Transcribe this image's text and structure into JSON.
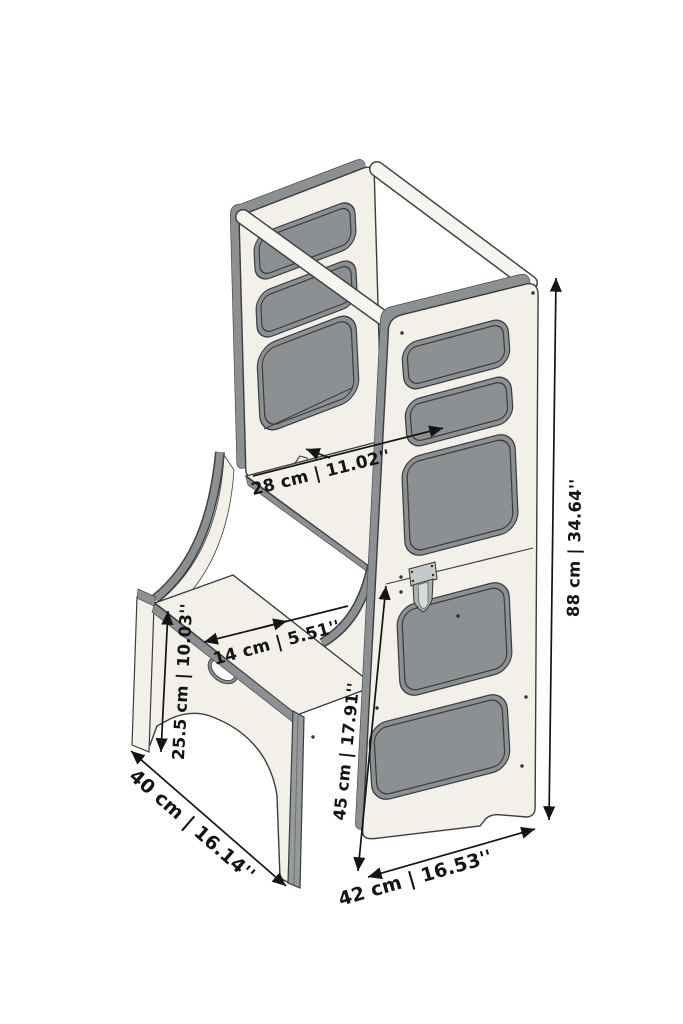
{
  "drawing": {
    "subject": "learning tower with step stool",
    "dimensions": {
      "platform_depth": {
        "label": "28 cm | 11.02''"
      },
      "step_depth": {
        "label": "14 cm | 5.51''"
      },
      "step_height": {
        "label": "25.5 cm | 10.03''"
      },
      "lower_section_height": {
        "label": "45 cm | 17.91''"
      },
      "total_height": {
        "label": "88 cm | 34.64''"
      },
      "depth": {
        "label": "40 cm | 16.14''"
      },
      "width": {
        "label": "42 cm | 16.53''"
      }
    },
    "colors": {
      "background": "#ffffff",
      "panel_face": "#f2f0e9",
      "panel_edge": "#8d9092",
      "outline": "#3a3d40",
      "dimension": "#141414"
    }
  }
}
